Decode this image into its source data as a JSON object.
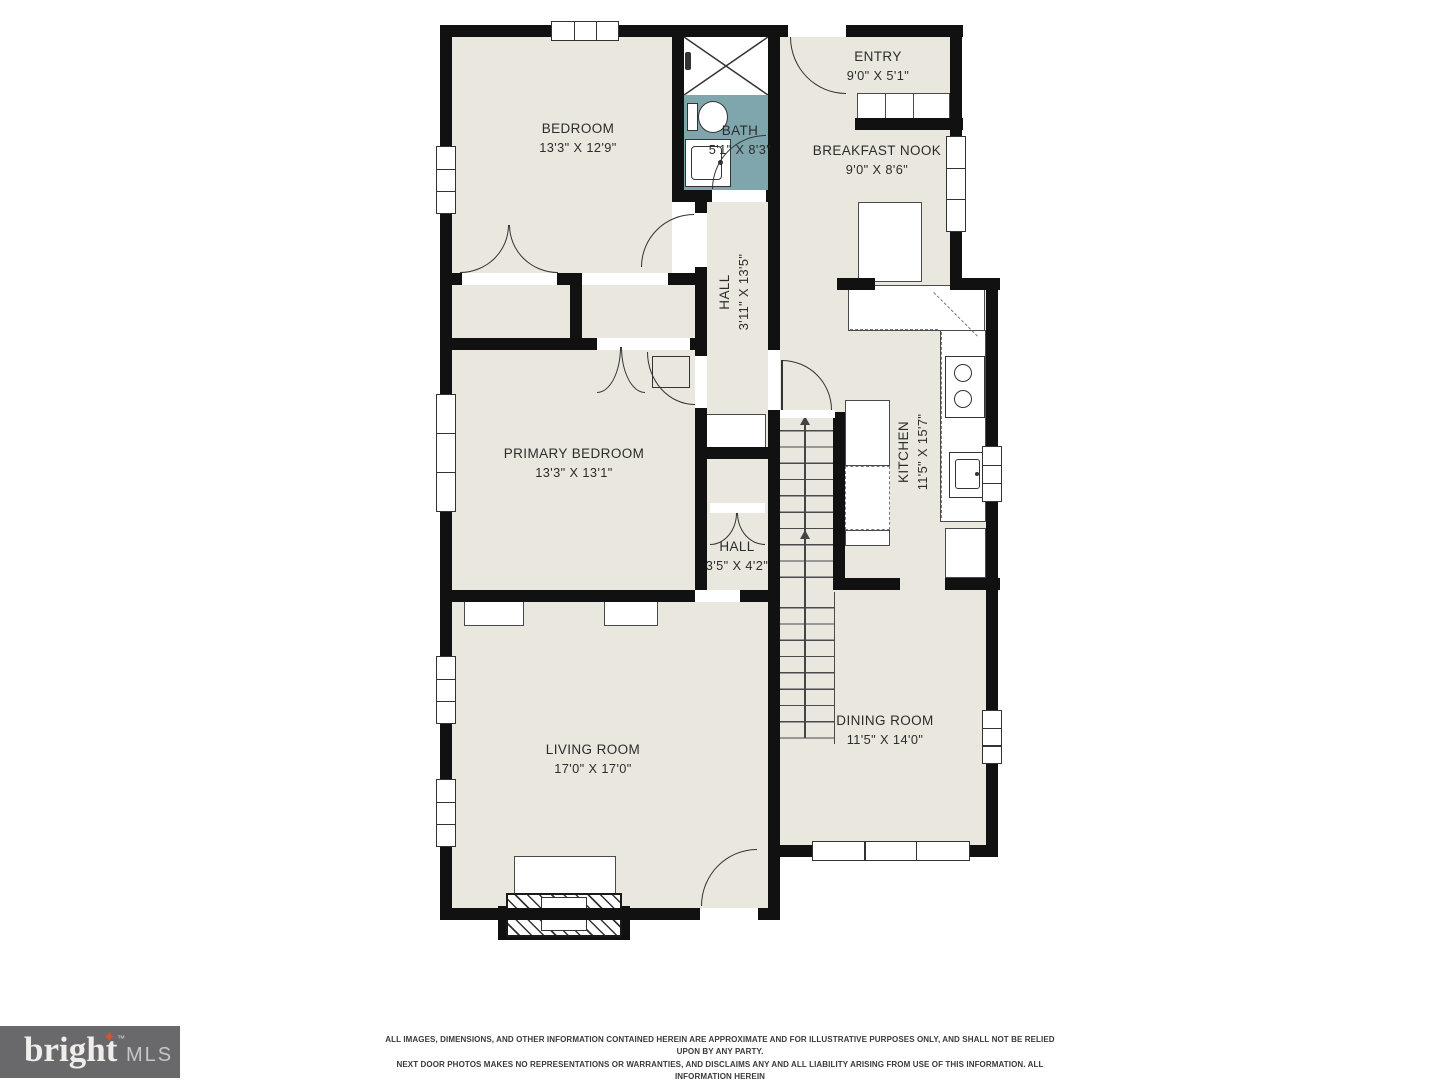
{
  "rooms": [
    {
      "name": "BEDROOM",
      "dims": "13'3\" X 12'9\""
    },
    {
      "name": "BATH",
      "dims": "5'1\" X 8'3\""
    },
    {
      "name": "ENTRY",
      "dims": "9'0\" X 5'1\""
    },
    {
      "name": "BREAKFAST NOOK",
      "dims": "9'0\" X 8'6\""
    },
    {
      "name": "HALL",
      "dims": "3'11\" X 13'5\""
    },
    {
      "name": "PRIMARY BEDROOM",
      "dims": "13'3\" X 13'1\""
    },
    {
      "name": "KITCHEN",
      "dims": "11'5\" X 15'7\""
    },
    {
      "name": "HALL",
      "dims": "3'5\" X 4'2\""
    },
    {
      "name": "LIVING ROOM",
      "dims": "17'0\" X 17'0\""
    },
    {
      "name": "DINING ROOM",
      "dims": "11'5\" X 14'0\""
    }
  ],
  "branding": {
    "logo_text": "bright",
    "logo_star": "✦",
    "logo_tm": "™",
    "logo_suffix": "MLS"
  },
  "disclaimer": {
    "line1": "ALL IMAGES, DIMENSIONS, AND OTHER INFORMATION CONTAINED HEREIN ARE APPROXIMATE AND FOR ILLUSTRATIVE PURPOSES ONLY, AND SHALL NOT BE RELIED UPON BY ANY PARTY.",
    "line2": "NEXT DOOR PHOTOS MAKES NO REPRESENTATIONS OR WARRANTIES, AND DISCLAIMS ANY AND ALL LIABILITY ARISING FROM USE OF THIS INFORMATION. ALL INFORMATION HEREIN",
    "line3": "SHALL BE SUBJECT TO THE TERMS AND CONDITIONS FOUND AT NEXTDOORPHOTOS.COM/TC."
  },
  "colors": {
    "room_fill": "#e9e7de",
    "bath_fill": "#7fa6ad",
    "wall": "#111111",
    "logo_bg": "#69696c",
    "logo_star": "#d9532b"
  }
}
